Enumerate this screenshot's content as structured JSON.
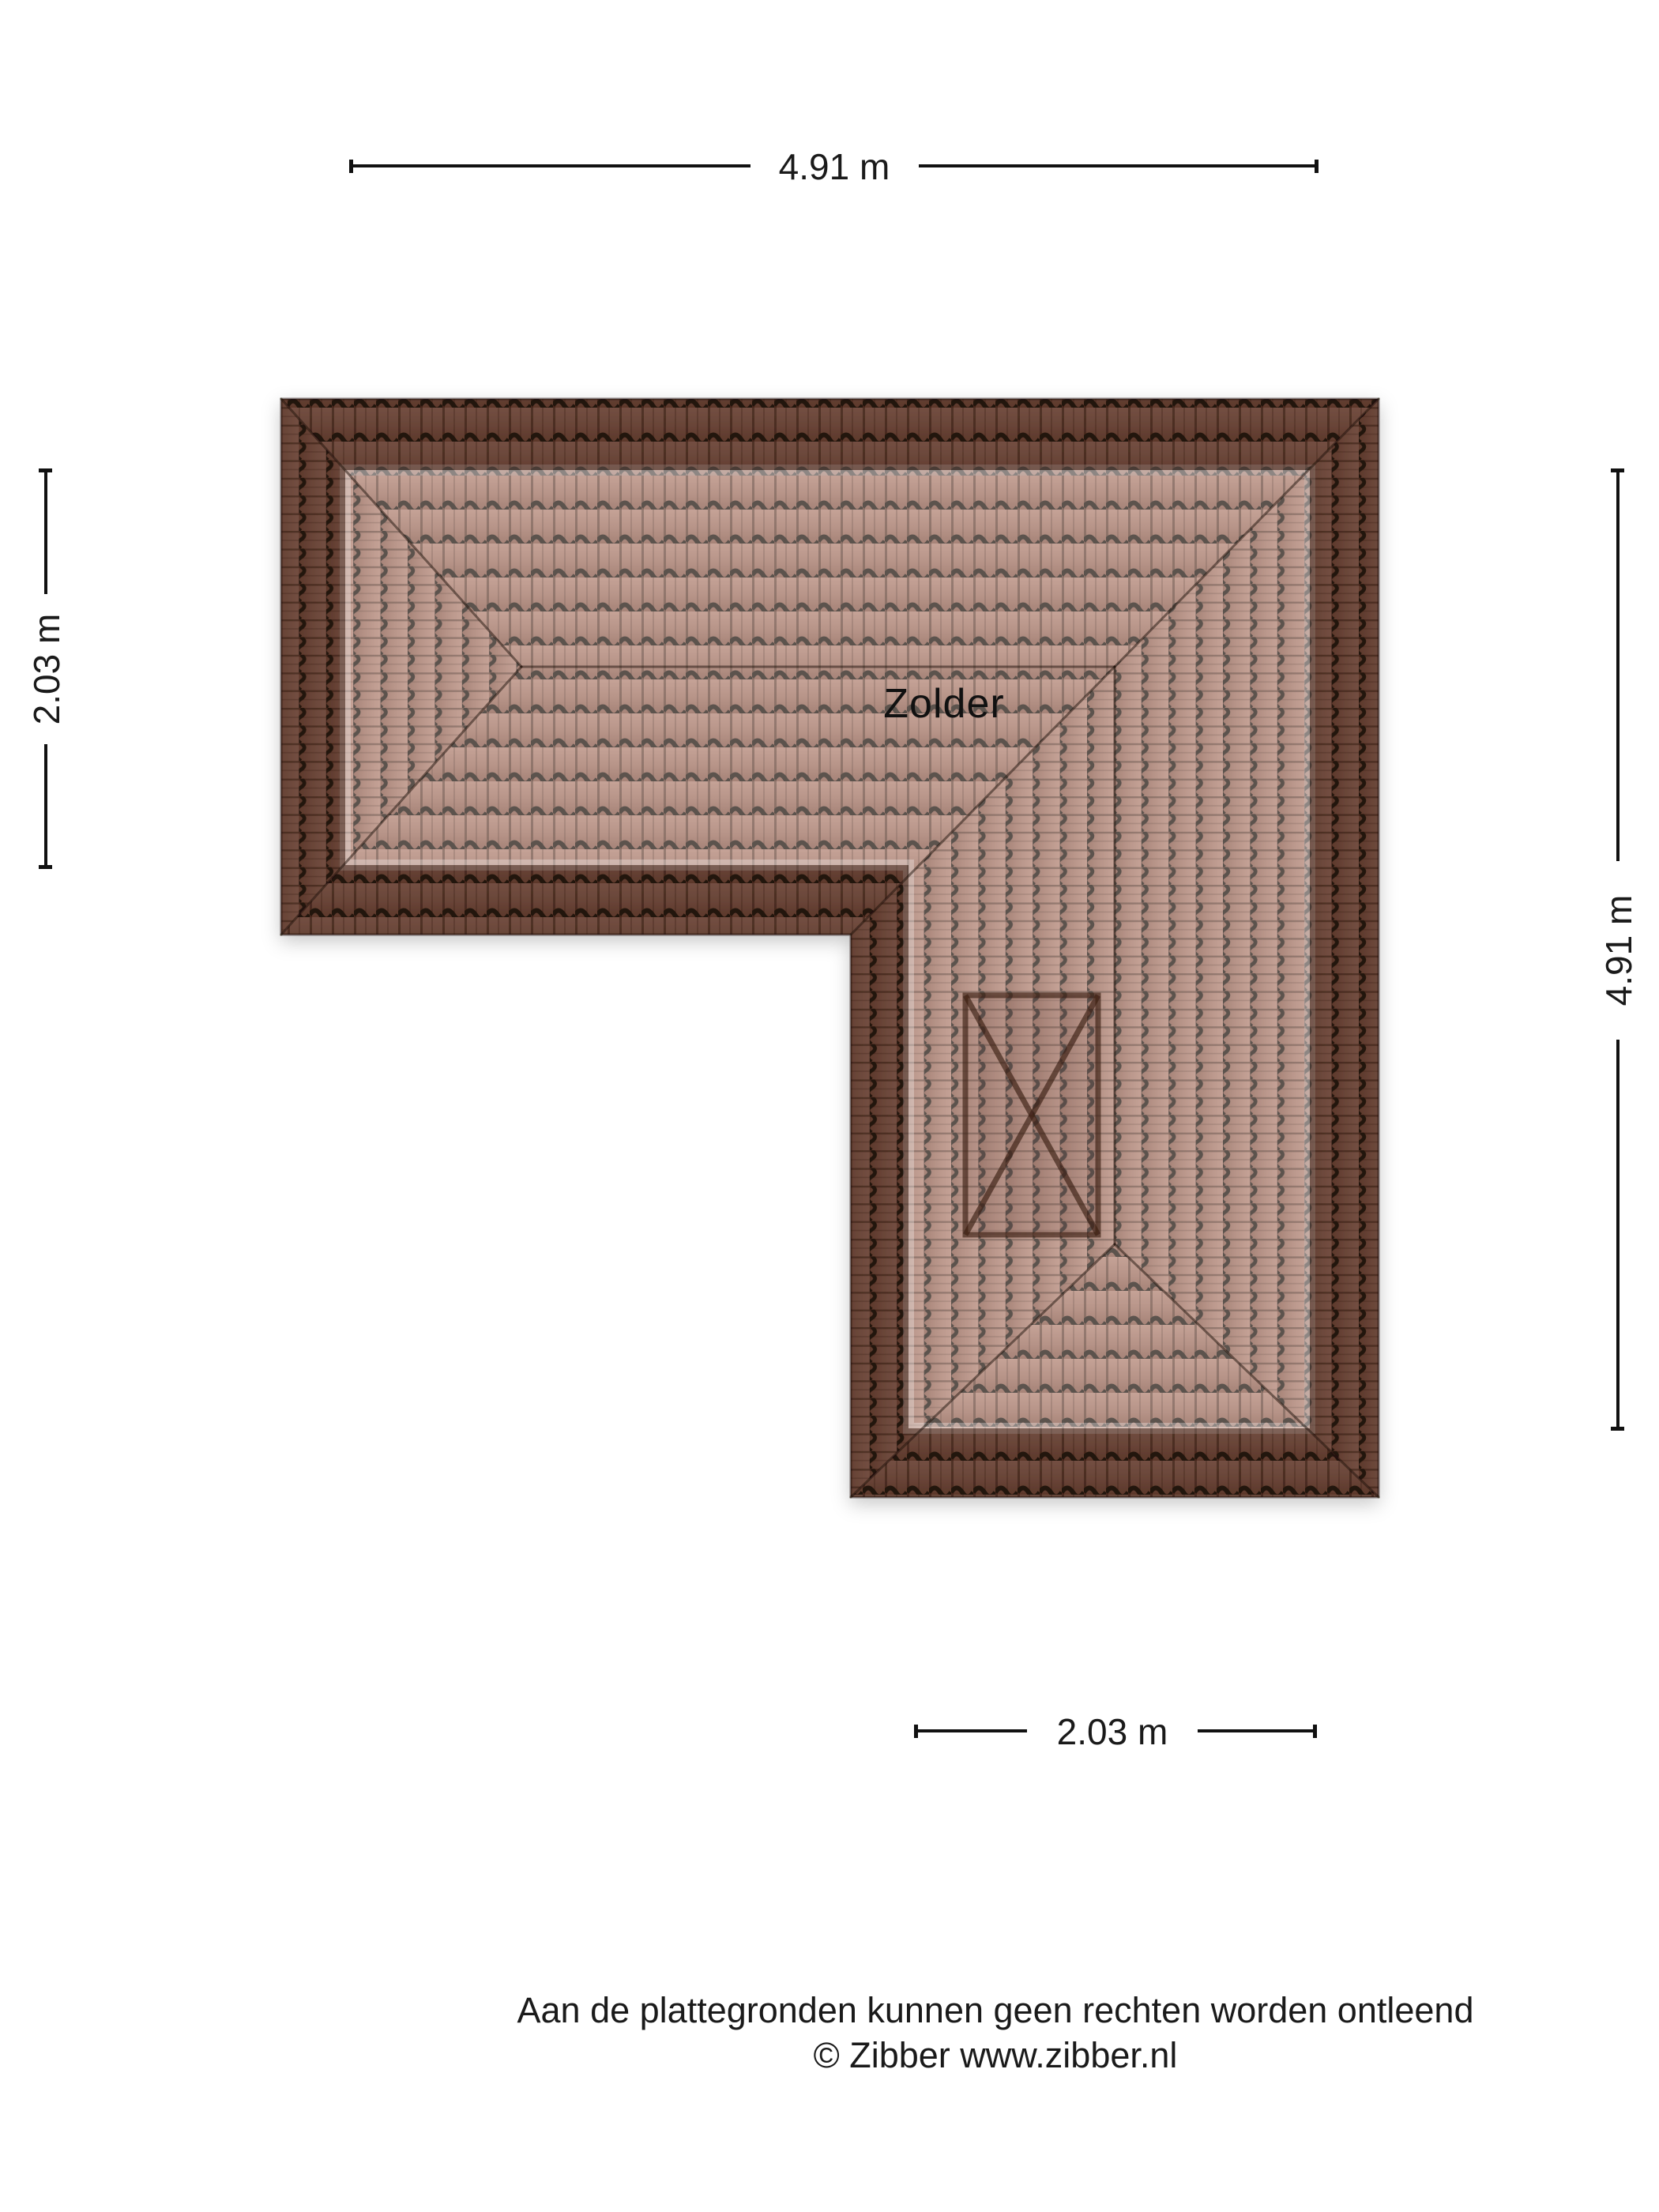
{
  "page": {
    "background_color": "#ffffff"
  },
  "floorplan": {
    "room_label": "Zolder",
    "dimensions": {
      "top": "4.91 m",
      "left": "2.03 m",
      "right": "4.91 m",
      "bottom": "2.03 m"
    },
    "features": {
      "roof_window": "x-marked-roof-window"
    },
    "colors": {
      "tile_light": "#b08070",
      "tile_mid": "#9c6c5c",
      "tile_dark": "#865646",
      "tile_groove": "#20130d",
      "eaves_shade_overlay": "rgba(43,20,11,0.45)",
      "room_highlight_overlay": "rgba(255,255,255,0.27)",
      "dimension_line_color": "#111111",
      "text_color": "#1a1a1a"
    }
  },
  "footer": {
    "disclaimer": "Aan de plattegronden kunnen geen rechten worden ontleend",
    "copyright": "© Zibber www.zibber.nl"
  }
}
